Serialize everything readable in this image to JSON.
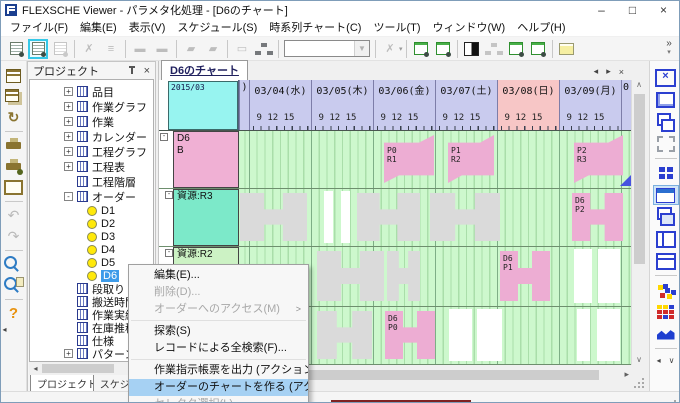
{
  "window": {
    "title": "FLEXSCHE Viewer - パラメタ化処理 - [D6のチャート]",
    "controls": {
      "minimize": "–",
      "maximize": "□",
      "close": "×"
    }
  },
  "glyphs": {
    "left": "◂",
    "right": "▸",
    "close": "×",
    "up": "∧",
    "down": "∨",
    "submenu": ">"
  },
  "menu_bar": [
    "ファイル(F)",
    "編集(E)",
    "表示(V)",
    "スケジュール(S)",
    "時系列チャート(C)",
    "ツール(T)",
    "ウィンドウ(W)",
    "ヘルプ(H)"
  ],
  "toolbar_top": [
    {
      "name": "timechart-settings-new",
      "t": "doc",
      "state": "normal"
    },
    {
      "name": "timechart-settings-edit",
      "t": "doc",
      "state": "selected"
    },
    {
      "name": "timechart-settings-copy",
      "t": "doc",
      "state": "disabled"
    },
    {
      "t": "sep"
    },
    {
      "name": "pegging-remove",
      "g": "✗",
      "state": "disabled"
    },
    {
      "name": "pegging-chain",
      "g": "≡",
      "state": "disabled"
    },
    {
      "t": "sep"
    },
    {
      "name": "bar-add",
      "g": "▬",
      "state": "disabled"
    },
    {
      "name": "bar-erase",
      "g": "▬",
      "state": "disabled"
    },
    {
      "t": "sep"
    },
    {
      "name": "flag-add",
      "g": "▰",
      "state": "disabled"
    },
    {
      "name": "flag-erase",
      "g": "▰",
      "state": "disabled"
    },
    {
      "t": "sep"
    },
    {
      "name": "window-delete",
      "g": "▭",
      "state": "disabled"
    },
    {
      "name": "window-link",
      "t": "org",
      "state": "normal"
    },
    {
      "t": "sep"
    },
    {
      "name": "selector-combo",
      "t": "combo",
      "state": "disabled"
    },
    {
      "t": "sep"
    },
    {
      "name": "unlink-gear",
      "g": "✗",
      "state": "disabled",
      "dd": true
    },
    {
      "t": "sep"
    },
    {
      "name": "chart-window-gear-1",
      "t": "docg",
      "state": "normal"
    },
    {
      "name": "chart-window-gear-2",
      "t": "docg",
      "state": "normal"
    },
    {
      "t": "sep"
    },
    {
      "name": "contrast-view",
      "t": "bw",
      "state": "normal"
    },
    {
      "name": "org-view",
      "t": "org",
      "state": "disabled"
    },
    {
      "name": "chart-refresh-all",
      "t": "docg",
      "state": "normal"
    },
    {
      "name": "chart-refresh",
      "t": "docg",
      "state": "normal"
    },
    {
      "t": "sep"
    },
    {
      "name": "memo-note",
      "t": "note",
      "state": "normal"
    }
  ],
  "toolbar_overflow": {
    "chevrons": "»",
    "arrow": "▾"
  },
  "toolbar_left": [
    {
      "name": "save",
      "t": "save"
    },
    {
      "name": "save-copy",
      "t": "save2"
    },
    {
      "name": "reload",
      "g": "↻"
    },
    {
      "t": "sep"
    },
    {
      "name": "print",
      "t": "print"
    },
    {
      "name": "print-setup",
      "t": "print2"
    },
    {
      "name": "print-preview",
      "t": "prev"
    },
    {
      "t": "sep"
    },
    {
      "name": "undo",
      "g": "↶",
      "state": "disabled"
    },
    {
      "name": "redo",
      "g": "↷",
      "state": "disabled"
    },
    {
      "t": "sep"
    },
    {
      "name": "search",
      "t": "mag"
    },
    {
      "name": "search-results",
      "t": "mag2"
    },
    {
      "t": "sep"
    },
    {
      "name": "help",
      "g": "?",
      "cl": "help"
    },
    {
      "name": "collapse-toolbar",
      "g": "◂",
      "cl": "tiny"
    }
  ],
  "toolbar_right": [
    {
      "name": "chart-delete",
      "t": "xbox"
    },
    {
      "name": "chart-restore",
      "t": "winover"
    },
    {
      "name": "chart-new-window",
      "t": "overlap"
    },
    {
      "name": "zoom-selection",
      "t": "corners"
    },
    {
      "t": "sep"
    },
    {
      "name": "tile-windows",
      "t": "tile4"
    },
    {
      "name": "chart-view",
      "t": "chartwin",
      "state": "selected"
    },
    {
      "name": "cascade-windows",
      "t": "cascade"
    },
    {
      "name": "split-vertical",
      "t": "vsplit"
    },
    {
      "name": "split-horizontal",
      "t": "hsplit"
    },
    {
      "t": "sep"
    },
    {
      "name": "resource-map",
      "t": "scatter"
    },
    {
      "name": "load-grid",
      "t": "cgrid"
    },
    {
      "name": "load-graph",
      "t": "area"
    },
    {
      "t": "sep"
    },
    {
      "name": "dock-arrows",
      "t": "pair",
      "glyphs": [
        "◂",
        "∨"
      ]
    }
  ],
  "project_panel": {
    "title": "プロジェクト",
    "close_glyph": "×",
    "tabs": [
      {
        "label": "プロジェクト",
        "active": true
      },
      {
        "label": "スケジュール",
        "active": false
      }
    ],
    "tree": [
      {
        "label": "品目",
        "icon": "table",
        "expand": "+"
      },
      {
        "label": "作業グラフ",
        "icon": "table",
        "expand": "+"
      },
      {
        "label": "作業",
        "icon": "table",
        "expand": "+"
      },
      {
        "label": "カレンダー",
        "icon": "table",
        "expand": "+"
      },
      {
        "label": "工程グラフ",
        "icon": "table",
        "expand": "+"
      },
      {
        "label": "工程表",
        "icon": "table",
        "expand": "+"
      },
      {
        "label": "工程階層",
        "icon": "table",
        "expand": ""
      },
      {
        "label": "オーダー",
        "icon": "table",
        "expand": "-"
      },
      {
        "label": "D1",
        "icon": "order",
        "indent": 1
      },
      {
        "label": "D2",
        "icon": "order",
        "indent": 1
      },
      {
        "label": "D3",
        "icon": "order",
        "indent": 1
      },
      {
        "label": "D4",
        "icon": "order",
        "indent": 1
      },
      {
        "label": "D5",
        "icon": "order",
        "indent": 1
      },
      {
        "label": "D6",
        "icon": "order",
        "indent": 1,
        "selected": true
      },
      {
        "label": "段取り",
        "icon": "table",
        "expand": ""
      },
      {
        "label": "搬送時間",
        "icon": "table",
        "expand": ""
      },
      {
        "label": "作業実績",
        "icon": "table",
        "expand": ""
      },
      {
        "label": "在庫推移",
        "icon": "table",
        "expand": ""
      },
      {
        "label": "仕様",
        "icon": "table",
        "expand": ""
      },
      {
        "label": "パターン",
        "icon": "table",
        "expand": "+"
      }
    ]
  },
  "chart": {
    "tab": "D6のチャート",
    "corner_label": "2015/03",
    "tick_labels": "9 12 15",
    "columns": [
      {
        "label": ")",
        "w": 10,
        "partial": true
      },
      {
        "label": "03/04(水)",
        "w": 62
      },
      {
        "label": "03/05(木)",
        "w": 62
      },
      {
        "label": "03/06(金)",
        "w": 62
      },
      {
        "label": "03/07(土)",
        "w": 62
      },
      {
        "label": "03/08(日)",
        "w": 62,
        "sunday": true
      },
      {
        "label": "03/09(月)",
        "w": 62
      },
      {
        "label": "0",
        "w": 9,
        "partial": true
      }
    ],
    "rows": [
      {
        "label_lines": [
          "D6",
          "B"
        ],
        "color": "#f0b0d4",
        "h": 58,
        "expander": "-",
        "bars": [
          {
            "type": "banner",
            "x": 145,
            "w": 50,
            "lines": [
              "P0",
              "R1"
            ]
          },
          {
            "type": "banner",
            "x": 209,
            "w": 46,
            "lines": [
              "P1",
              "R2"
            ]
          },
          {
            "type": "banner",
            "x": 335,
            "w": 49,
            "lines": [
              "P2",
              "R3"
            ]
          },
          {
            "type": "tri",
            "x": 381,
            "w": 11
          }
        ]
      },
      {
        "label_lines": [
          "資源:R3"
        ],
        "color": "#7ce9c9",
        "h": 58,
        "expander": "-",
        "bars": [
          {
            "type": "h",
            "x": 1,
            "w": 67
          },
          {
            "type": "white",
            "x": 85,
            "w": 9
          },
          {
            "type": "white",
            "x": 102,
            "w": 9
          },
          {
            "type": "h",
            "x": 118,
            "w": 63
          },
          {
            "type": "h",
            "x": 191,
            "w": 70
          },
          {
            "type": "hpink",
            "x": 333,
            "w": 51,
            "lines": [
              "D6",
              "P2"
            ]
          }
        ]
      },
      {
        "label_lines": [
          "資源:R2"
        ],
        "color": "#ccf2c4",
        "h": 60,
        "expander": "-",
        "bars": [
          {
            "type": "h",
            "x": 78,
            "w": 67
          },
          {
            "type": "h",
            "x": 148,
            "w": 33
          },
          {
            "type": "hpink",
            "x": 261,
            "w": 50,
            "lines": [
              "D6",
              "P1"
            ]
          },
          {
            "type": "white",
            "x": 335,
            "w": 18
          },
          {
            "type": "white",
            "x": 359,
            "w": 22
          }
        ]
      },
      {
        "label_lines": [
          "資源:R1"
        ],
        "color": "#ccf2c4",
        "h": 58,
        "expander": "-",
        "bars": [
          {
            "type": "h",
            "x": 78,
            "w": 55
          },
          {
            "type": "hpink",
            "x": 146,
            "w": 50,
            "lines": [
              "D6",
              "P0"
            ]
          },
          {
            "type": "white",
            "x": 210,
            "w": 23
          },
          {
            "type": "white",
            "x": 238,
            "w": 25
          },
          {
            "type": "white",
            "x": 338,
            "w": 13
          },
          {
            "type": "white",
            "x": 358,
            "w": 23
          }
        ]
      }
    ]
  },
  "context_menu": {
    "items": [
      {
        "label": "編集(E)...",
        "state": "normal"
      },
      {
        "label": "削除(D)...",
        "state": "disabled"
      },
      {
        "label": "オーダーへのアクセス(M)",
        "state": "disabled",
        "submenu": true
      },
      {
        "separator": true
      },
      {
        "label": "探索(S)",
        "state": "normal"
      },
      {
        "label": "レコードによる全検索(F)...",
        "state": "normal"
      },
      {
        "separator": true
      },
      {
        "label": "作業指示帳票を出力 (アクション)",
        "state": "normal"
      },
      {
        "label": "オーダーのチャートを作る (アクション)",
        "state": "highlighted"
      },
      {
        "label": "セレクタ選択(L)...",
        "state": "disabled"
      }
    ]
  },
  "colors": {
    "order_row_pink": "#f0b0d4",
    "resource_teal": "#7ce9c9",
    "resource_green": "#ccf2c4",
    "bar_gray": "#dadada",
    "bar_pink": "#edadd3",
    "chart_bg_green": "#cdf8cd",
    "weekday_header": "#c9cbee",
    "sunday_header": "#f7c6c6",
    "corner_cyan": "#97f4f0",
    "menu_highlight": "#a6d1f3",
    "maroon_strip": "#7e2222"
  }
}
